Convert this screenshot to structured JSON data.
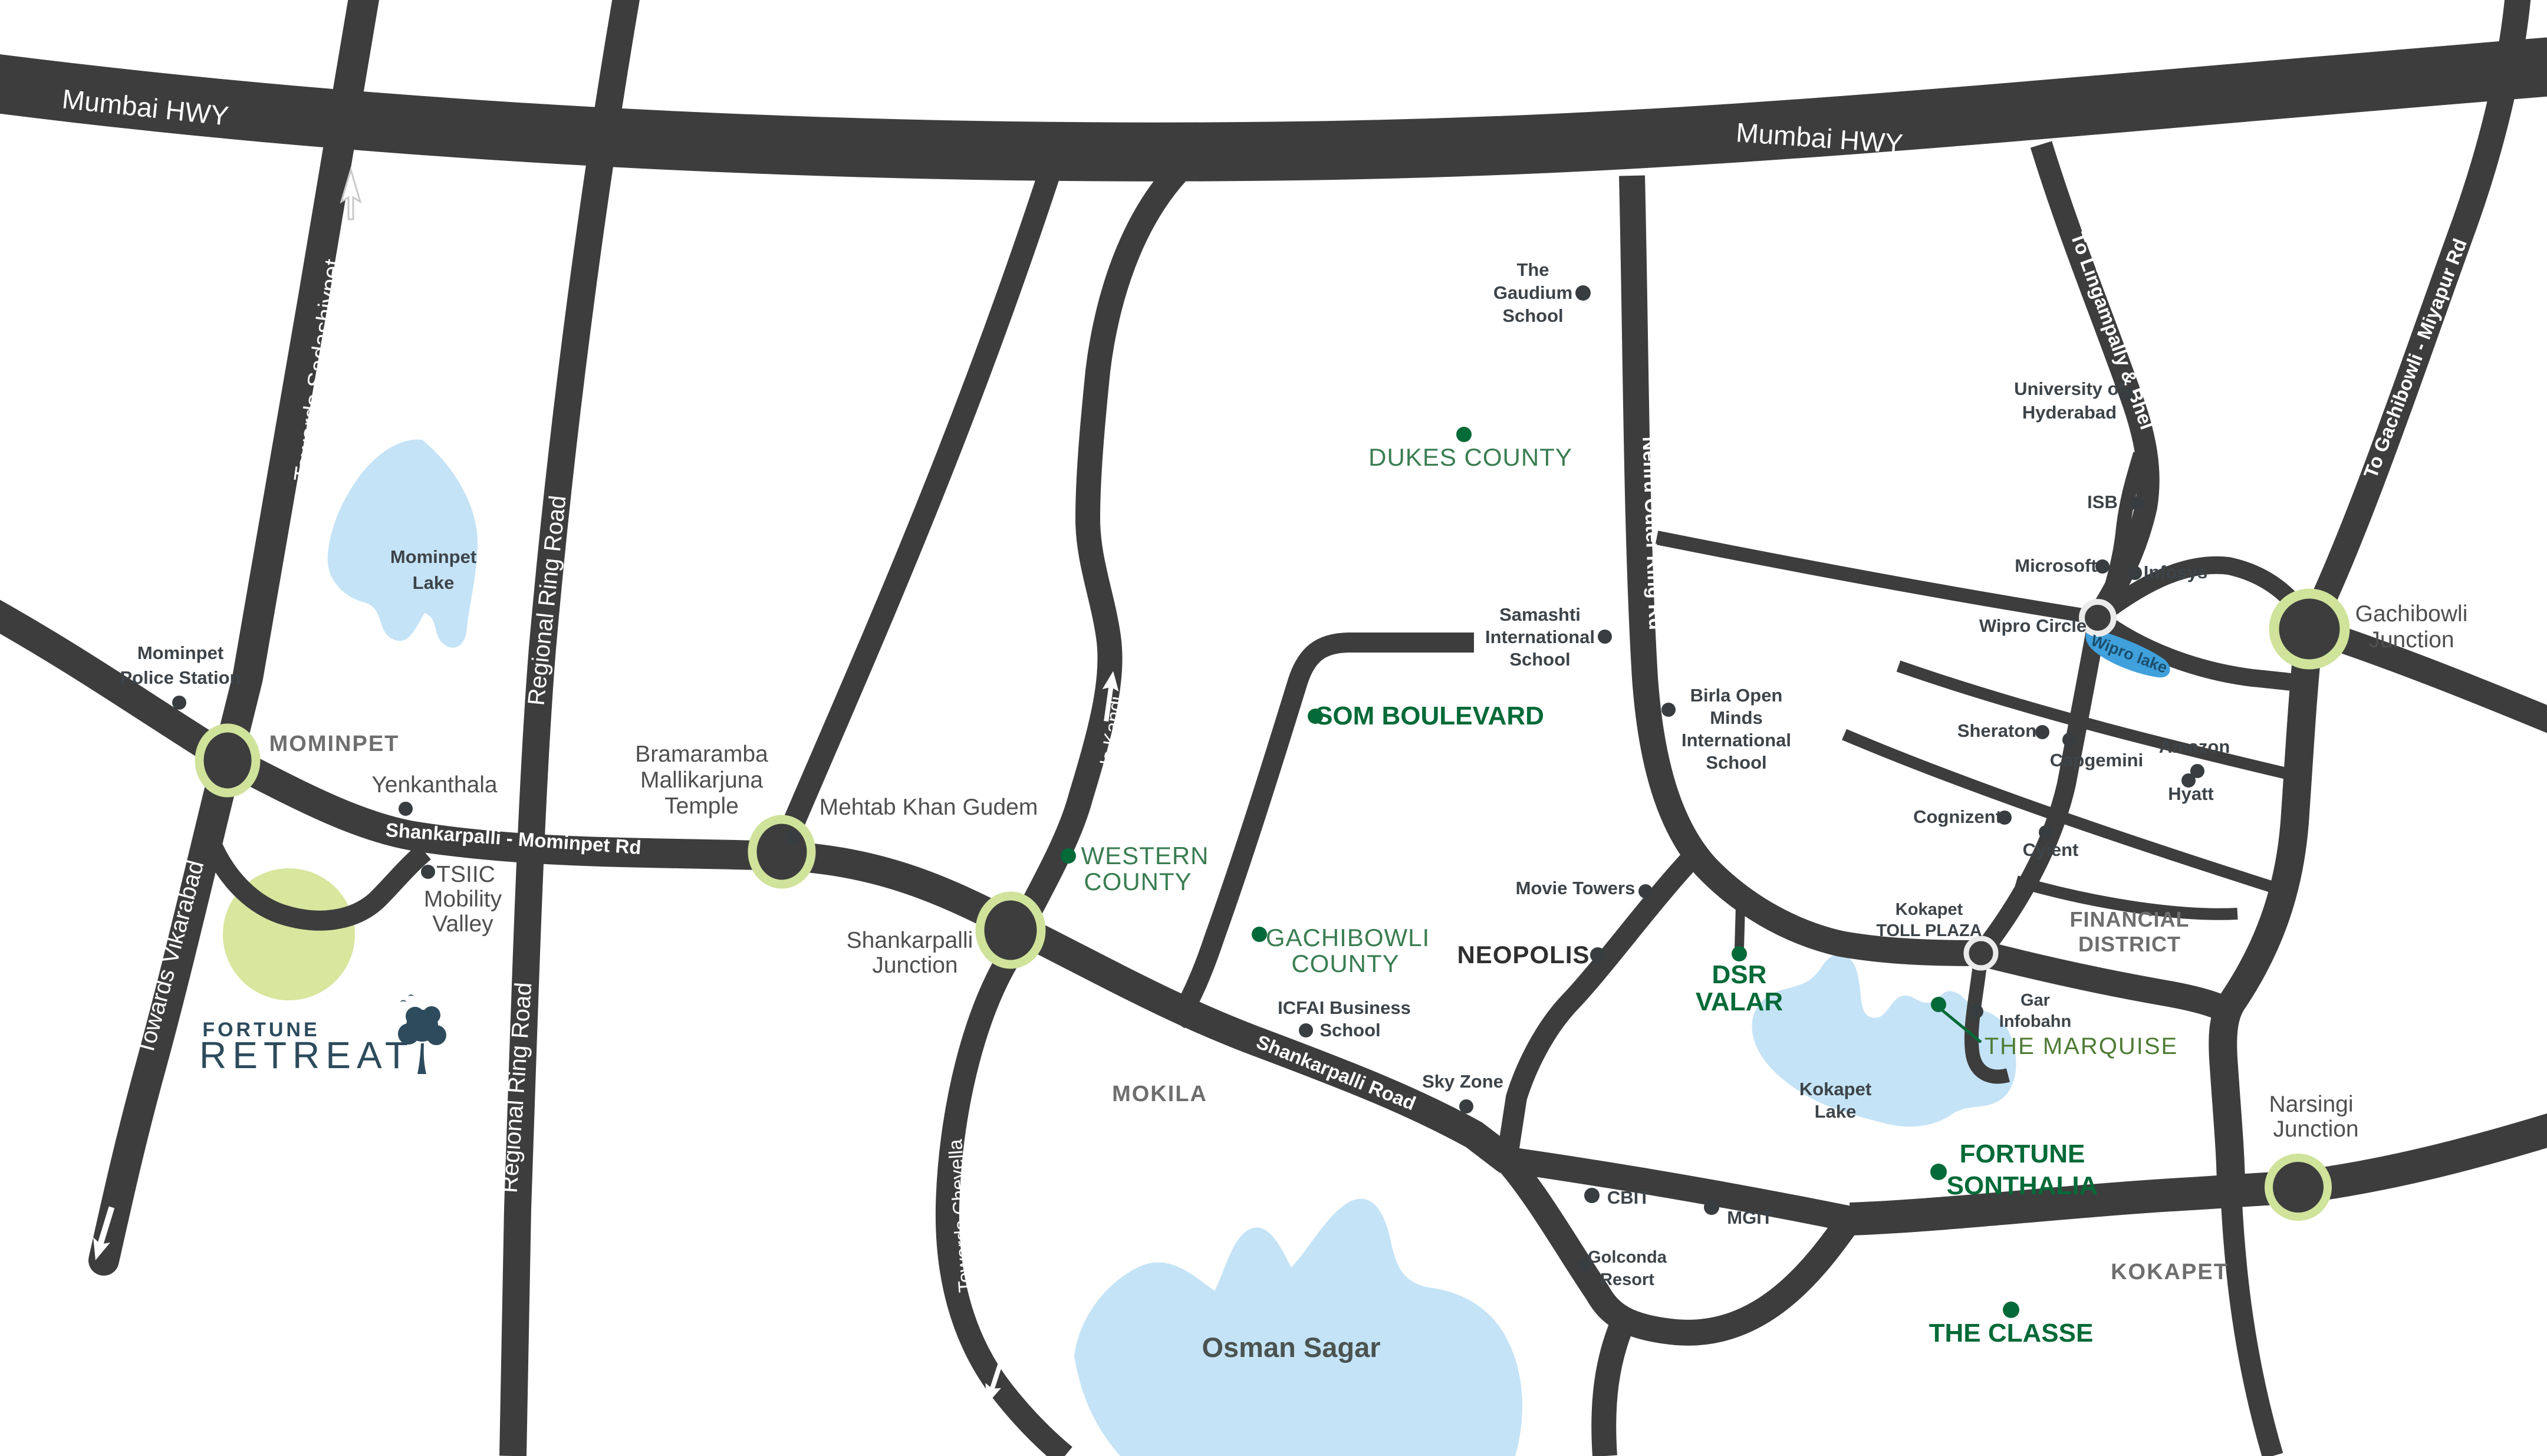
{
  "map_title": "Fortune Retreat location map",
  "colors": {
    "road": "#3d3d3d",
    "lake": "#c5e3f6",
    "wipro_lake": "#3fa0dc",
    "junction_ring": "#cfe39b",
    "site_circle": "#d8e69e",
    "project_green": "#046a38",
    "county_green": "#3a7d52",
    "marquise_green": "#4e7b35",
    "landmark_text": "#3d4449",
    "muted_text": "#6e6e6e",
    "brand_navy": "#2d4b5c",
    "white_road_text": "#ffffff"
  },
  "brand": {
    "line1": "FORTUNE",
    "line2": "RETREAT"
  },
  "labels": {
    "mumbai_hwy_left": "Mumbai HWY",
    "mumbai_hwy_right": "Mumbai HWY",
    "towards_sadashivpet": "Towards Sadashivpet",
    "towards_vikarabad": "Towards Vikarabad",
    "regional_ring_road_1": "Regional Ring Road",
    "regional_ring_road_2": "Regional Ring Road",
    "shankarpalli_mominpet_rd": "Shankarpalli - Mominpet Rd",
    "shankarpalli_road": "Shankarpalli Road",
    "towards_kandi": "Towards Kandi",
    "towards_chevella": "Towards Chevella",
    "nehru_orr": "Nehru Outer Ring Rd",
    "to_lingampally": "To Lingampally & Bhel",
    "to_gachibowli_miyapur": "To Gachibowli - Miyapur Rd",
    "old_mumbai_hwy": "Old Mumbai Hwy",
    "to_shamshabad": "To Shamshabad Airport",
    "mominpet_lake_l1": "Mominpet",
    "mominpet_lake_l2": "Lake",
    "mominpet_ps_l1": "Mominpet",
    "mominpet_ps_l2": "Police Station",
    "mominpet_town": "MOMINPET",
    "yenkanthala": "Yenkanthala",
    "bramaramba_l1": "Bramaramba",
    "bramaramba_l2": "Mallikarjuna",
    "bramaramba_l3": "Temple",
    "tsiic_l1": "TSIIC",
    "tsiic_l2": "Mobility",
    "tsiic_l3": "Valley",
    "mehtab": "Mehtab Khan Gudem",
    "shankarpalli_jn_l1": "Shankarpalli",
    "shankarpalli_jn_l2": "Junction",
    "western_l1": "WESTERN",
    "western_l2": "COUNTY",
    "mokila": "MOKILA",
    "sky_zone": "Sky Zone",
    "osman_sagar": "Osman Sagar",
    "gaudium_l1": "The",
    "gaudium_l2": "Gaudium",
    "gaudium_l3": "School",
    "dukes_county": "DUKES COUNTY",
    "samashti_l1": "Samashti",
    "samashti_l2": "International",
    "samashti_l3": "School",
    "som_boulevard": "SOM BOULEVARD",
    "birla_l1": "Birla Open",
    "birla_l2": "Minds",
    "birla_l3": "International",
    "birla_l4": "School",
    "movie_towers": "Movie Towers",
    "neopolis": "NEOPOLIS",
    "gachibowli_county_l1": "GACHIBOWLI",
    "gachibowli_county_l2": "COUNTY",
    "icfai_l1": "ICFAI Business",
    "icfai_l2": "School",
    "dsr_l1": "DSR",
    "dsr_l2": "VALAR",
    "kokapet_lake_l1": "Kokapet",
    "kokapet_lake_l2": "Lake",
    "fortune_sonthalia_l1": "FORTUNE",
    "fortune_sonthalia_l2": "SONTHALIA",
    "the_classe": "THE CLASSE",
    "cbit": "CBIT",
    "mgit": "MGIT",
    "golconda_l1": "Golconda",
    "golconda_l2": "Resort",
    "kokapet_area": "KOKAPET",
    "narsingi_l1": "Narsingi",
    "narsingi_l2": "Junction",
    "gachibowli_jn_l1": "Gachibowli",
    "gachibowli_jn_l2": "Junction",
    "university_l1": "University of",
    "university_l2": "Hyderabad",
    "isb": "ISB",
    "microsoft": "Microsoft",
    "infosys": "Infosys",
    "wipro_circle": "Wipro Circle",
    "wipro_lake": "Wipro lake",
    "sheraton": "Sheraton",
    "capgemini": "Capgemini",
    "amazon": "Amazon",
    "hyatt": "Hyatt",
    "cognizent": "Cognizent",
    "cyient": "Cyient",
    "toll_l1": "Kokapet",
    "toll_l2": "TOLL PLAZA",
    "financial_l1": "FINANCIAL",
    "financial_l2": "DISTRICT",
    "gar_l1": "Gar",
    "gar_l2": "Infobahn",
    "the_marquise": "THE MARQUISE"
  }
}
